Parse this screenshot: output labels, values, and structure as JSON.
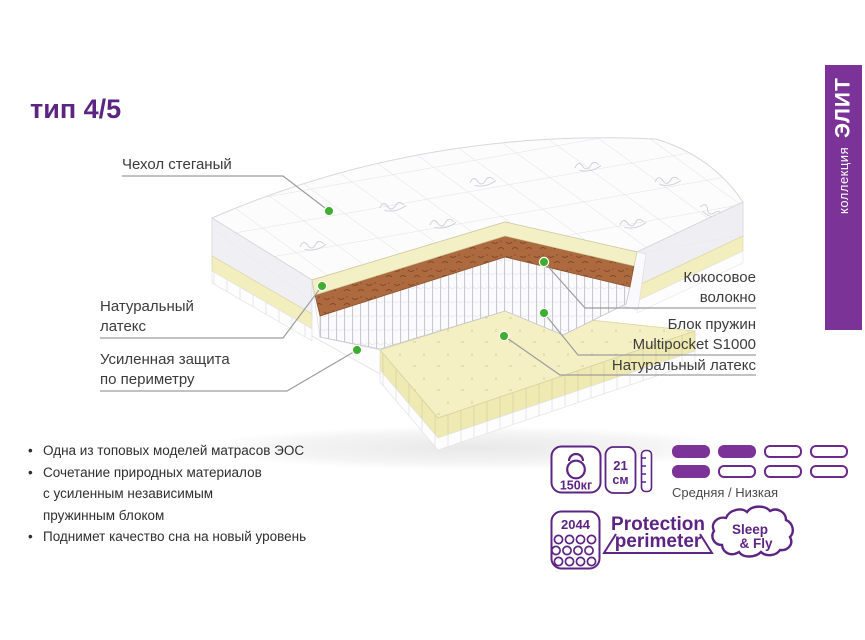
{
  "title": "тип 4/5",
  "banner": {
    "small": "коллекция",
    "big": "ЭЛИТ"
  },
  "callouts": {
    "cover": {
      "lines": [
        "Чехол стеганый"
      ]
    },
    "latex_left": {
      "lines": [
        "Натуральный",
        "латекс"
      ]
    },
    "perimeter": {
      "lines": [
        "Усиленная защита",
        "по периметру"
      ]
    },
    "coconut": {
      "lines": [
        "Кокосовое",
        "волокно"
      ]
    },
    "spring_block": {
      "lines": [
        "Блок пружин",
        "Multipocket S1000"
      ]
    },
    "latex_right": {
      "lines": [
        "Натуральный латекс"
      ]
    }
  },
  "features": [
    {
      "lines": [
        "Одна из топовых моделей матрасов ЭОС"
      ]
    },
    {
      "lines": [
        "Сочетание природных материалов",
        "с усиленным независимым",
        "пружинным блоком"
      ]
    },
    {
      "lines": [
        "Поднимет качество сна на новый уровень"
      ]
    }
  ],
  "specs": {
    "max_weight": "150кг",
    "height_value": "21",
    "height_unit": "см",
    "firmness": {
      "label": "Средняя / Низкая",
      "rows": [
        [
          true,
          true,
          false,
          false
        ],
        [
          true,
          false,
          false,
          false
        ]
      ]
    },
    "springs_count": "2044",
    "protection": {
      "line1": "Protection",
      "line2": "perimeter"
    },
    "brand": {
      "line1": "Sleep",
      "line2": "& Fly"
    }
  },
  "icons": {
    "weight": "kettlebell-icon",
    "height": "ruler-icon",
    "springs": "springs-count-icon",
    "brand": "cloud-logo"
  },
  "colors": {
    "purple_dark": "#5c2483",
    "purple_banner": "#7c3397",
    "green_dot": "#3dae2d",
    "latex_yellow": "#f4f0c6",
    "coconut_brown": "#ae6a3f"
  }
}
